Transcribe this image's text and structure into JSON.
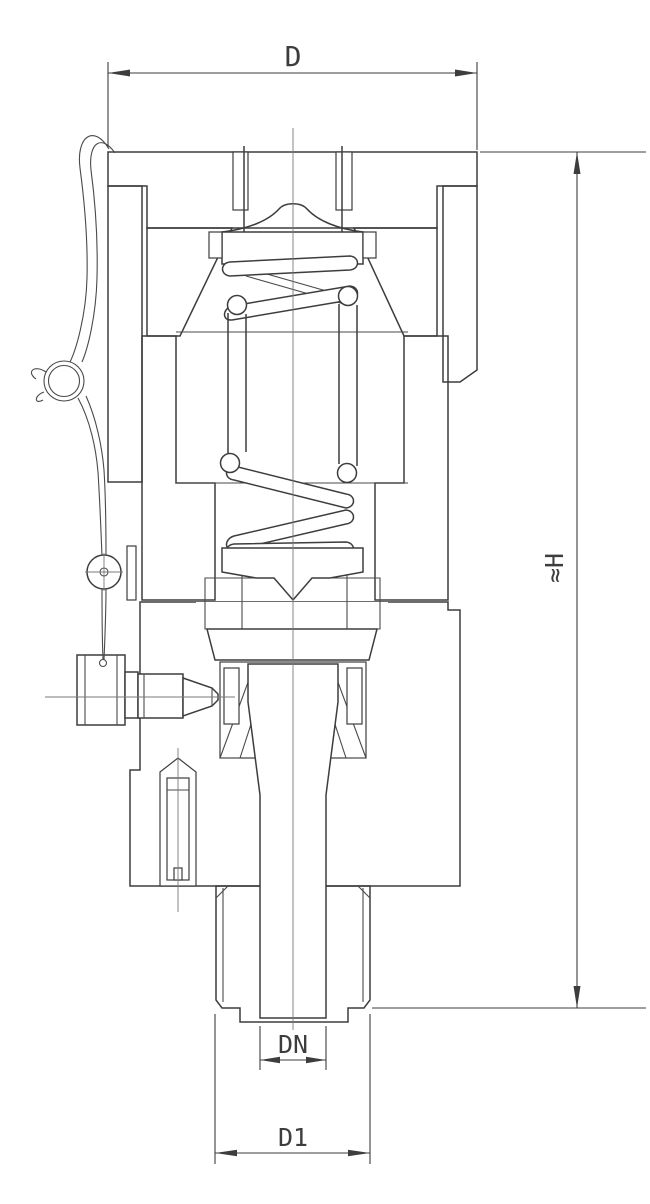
{
  "drawing": {
    "type": "valve-cross-section",
    "background_color": "#ffffff",
    "line_color": "#3d3d3d",
    "hatch_color": "#555555",
    "dimensions": {
      "outside_width": {
        "label": "D"
      },
      "overall_height": {
        "label": "≈H"
      },
      "nominal_bore": {
        "label": "DN"
      },
      "inlet_connection": {
        "label": "D1"
      }
    }
  }
}
